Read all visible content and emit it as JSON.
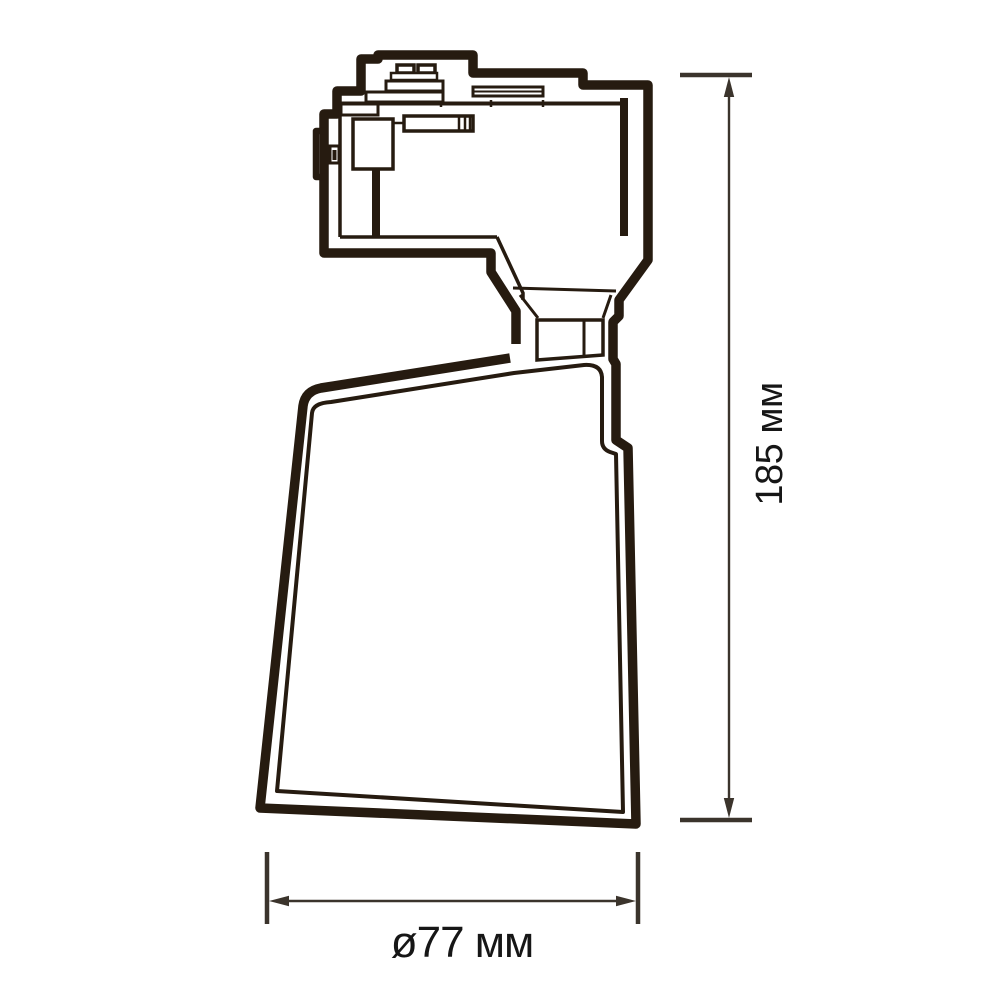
{
  "drawing": {
    "labels": {
      "height": "185 мм",
      "width": "ø77 мм"
    },
    "colors": {
      "line": "#261b10",
      "dimension": "#3b342c",
      "text": "#161616",
      "background": "#ffffff"
    }
  }
}
